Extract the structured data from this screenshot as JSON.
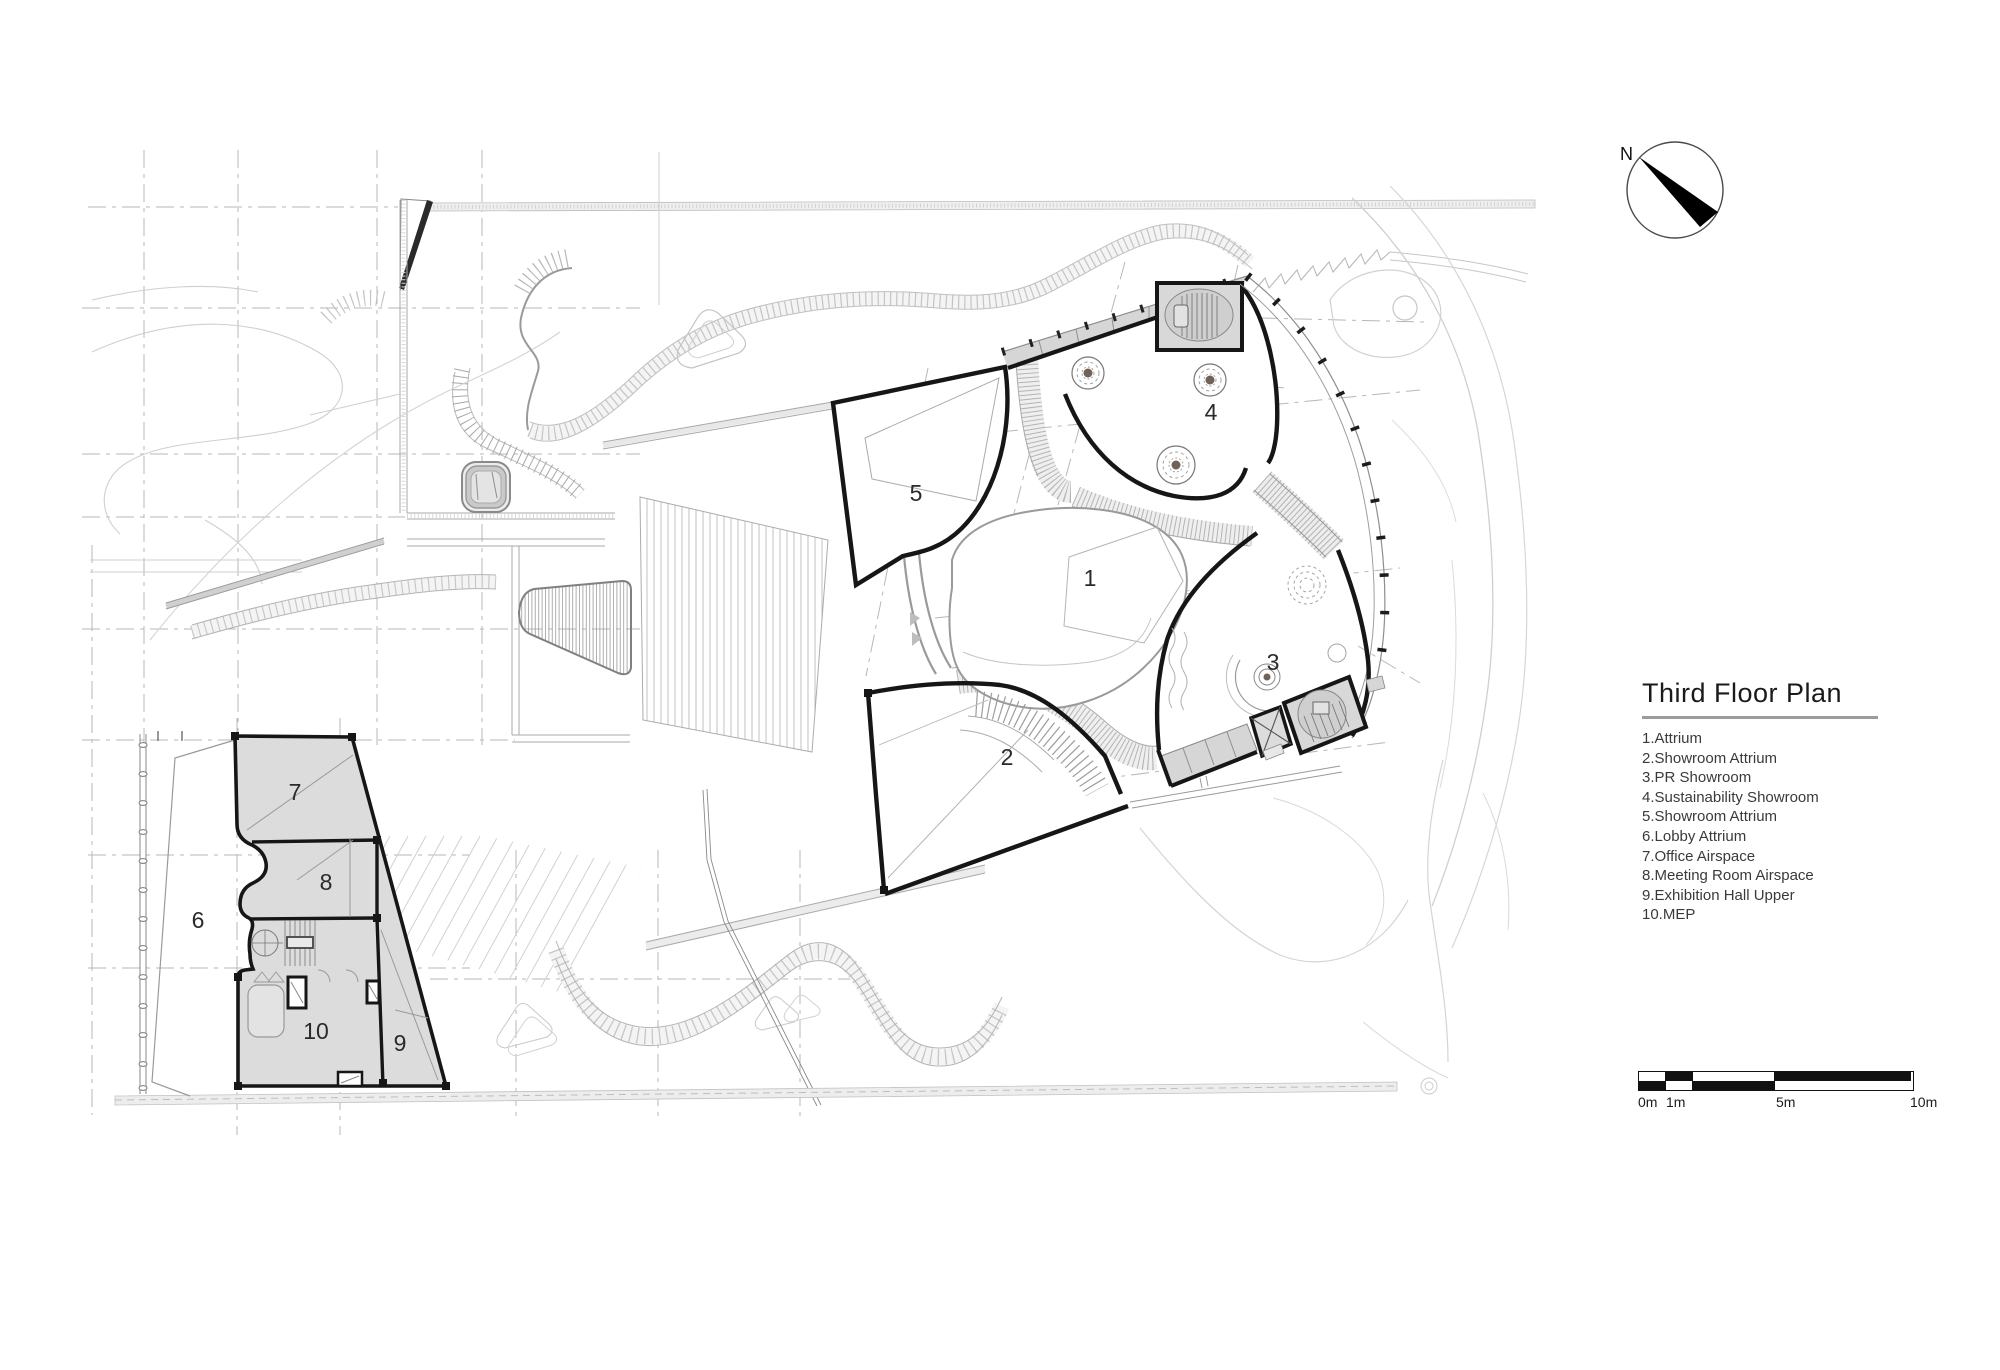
{
  "title_block": {
    "title": "Third Floor Plan"
  },
  "legend": {
    "items": [
      "1.Attrium",
      "2.Showroom Attrium",
      "3.PR Showroom",
      "4.Sustainability Showroom",
      "5.Showroom Attrium",
      "6.Lobby Attrium",
      "7.Office Airspace",
      "8.Meeting Room Airspace",
      "9.Exhibition Hall Upper",
      "10.MEP"
    ]
  },
  "compass": {
    "label": "N"
  },
  "scale_bar": {
    "labels": [
      "0m",
      "1m",
      "5m",
      "10m"
    ]
  },
  "plan": {
    "room_labels": [
      "1",
      "2",
      "3",
      "4",
      "5",
      "6",
      "7",
      "8",
      "9",
      "10"
    ]
  },
  "colors": {
    "wall": "#161616",
    "annex_fill": "#dcdcdc",
    "core_fill": "#d8d8d8",
    "tree_dot": "#6e6259",
    "underline": "#9c9c9c",
    "scale_black": "#111111"
  }
}
